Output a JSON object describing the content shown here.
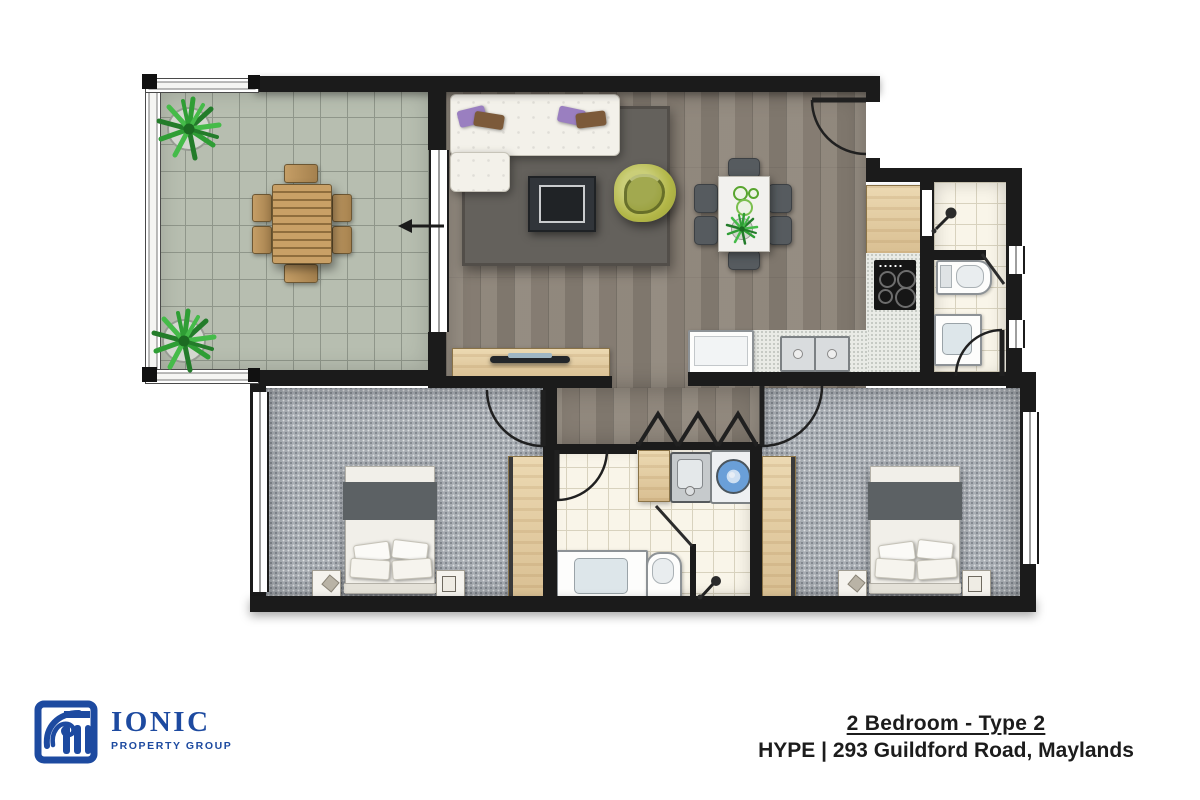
{
  "footer": {
    "logo_name": "IONIC",
    "logo_tagline": "PROPERTY GROUP",
    "plan_title": "2 Bedroom - Type 2",
    "plan_subtitle": "HYPE | 293 Guildford Road, Maylands"
  },
  "palette": {
    "wall": "#1b1b1b",
    "wood_floor": "#8d8479",
    "carpet": "#a9aeb4",
    "balcony_tile": "#b7beb0",
    "bathroom_tile": "#f9f5e9",
    "timber_joinery": "#e0c79d",
    "accent_chair_green": "#b2b647",
    "washer_blue": "#6a9fd8",
    "logo_blue": "#1d4aa0",
    "plant_green": "#2f9e35"
  }
}
